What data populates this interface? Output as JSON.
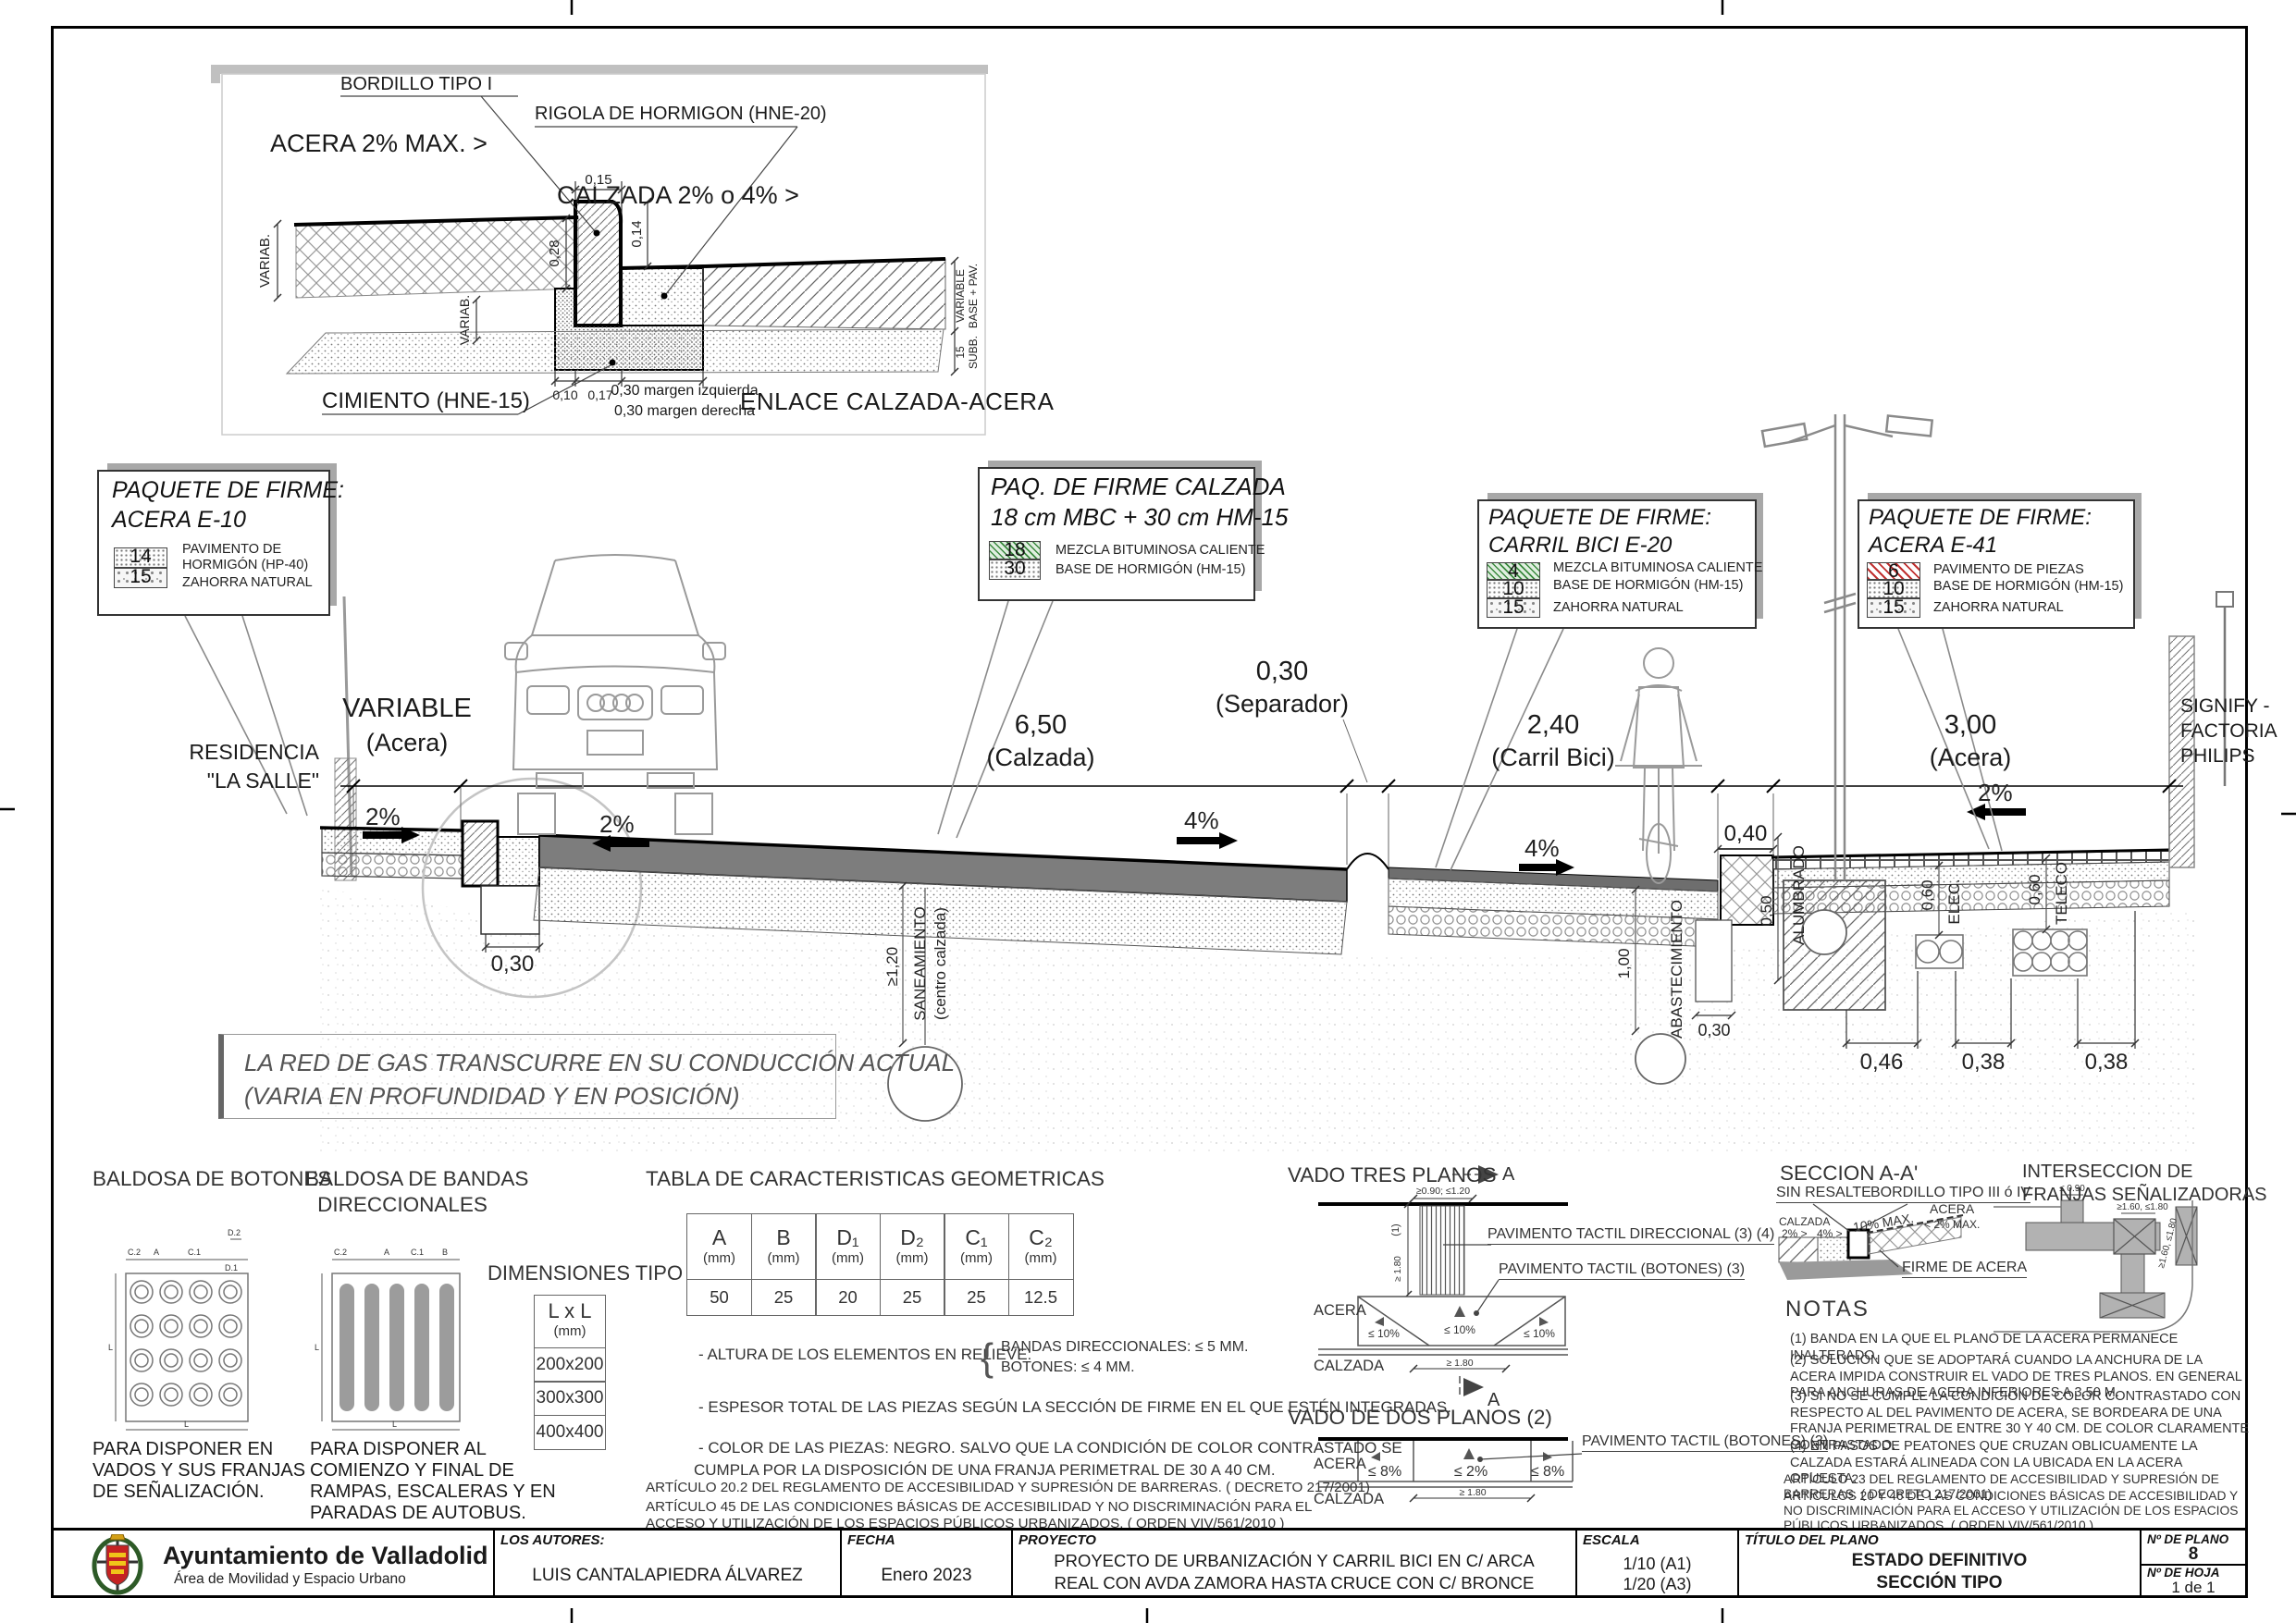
{
  "detail": {
    "title": "ENLACE CALZADA-ACERA",
    "label_bordillo": "BORDILLO TIPO I",
    "label_rigola": "RIGOLA DE HORMIGON (HNE-20)",
    "label_acera": "ACERA 2% MAX. >",
    "label_calzada": "CALZADA 2% o 4% >",
    "label_cimiento": "CIMIENTO (HNE-15)",
    "dim_015": "0,15",
    "dim_014": "0,14",
    "dim_028": "0,28",
    "dim_variab_left": "VARIAB.",
    "dim_variab_mid": "VARIAB.",
    "dim_010": "0,10",
    "dim_017": "0,17",
    "margen_1": "0,30 margen izquierda",
    "margen_2": "0,30 margen derecha",
    "dim_right_variable_1": "VARIABLE",
    "dim_right_variable_2": "BASE + PAV.",
    "dim_right_sub_1": "15",
    "dim_right_sub_2": "SUBB."
  },
  "callouts": {
    "e10": {
      "title1": "PAQUETE DE FIRME:",
      "title2": "ACERA E-10",
      "layers": [
        {
          "num": "14",
          "desc": "PAVIMENTO DE HORMIGÓN (HP-40)"
        },
        {
          "num": "15",
          "desc": "ZAHORRA NATURAL"
        }
      ]
    },
    "calzada": {
      "title1": "PAQ. DE FIRME CALZADA",
      "title2": "18 cm MBC  + 30  cm HM-15",
      "layers": [
        {
          "num": "18",
          "desc": "MEZCLA BITUMINOSA CALIENTE"
        },
        {
          "num": "30",
          "desc": "BASE DE HORMIGÓN (HM-15)"
        }
      ]
    },
    "e20": {
      "title1": "PAQUETE DE FIRME:",
      "title2": "CARRIL BICI E-20",
      "layers": [
        {
          "num": "4",
          "desc": "MEZCLA BITUMINOSA CALIENTE"
        },
        {
          "num": "10",
          "desc": "BASE DE HORMIGÓN (HM-15)"
        },
        {
          "num": "15",
          "desc": "ZAHORRA NATURAL"
        }
      ]
    },
    "e41": {
      "title1": "PAQUETE DE FIRME:",
      "title2": "ACERA E-41",
      "layers": [
        {
          "num": "6",
          "desc": "PAVIMENTO DE PIEZAS"
        },
        {
          "num": "10",
          "desc": "BASE DE HORMIGÓN (HM-15)"
        },
        {
          "num": "15",
          "desc": "ZAHORRA NATURAL"
        }
      ]
    }
  },
  "section": {
    "residencia_1": "RESIDENCIA",
    "residencia_2": "\"LA SALLE\"",
    "dim_variable": "VARIABLE",
    "dim_variable_sub": "(Acera)",
    "dim_calzada": "6,50",
    "dim_calzada_sub": "(Calzada)",
    "dim_separador": "0,30",
    "dim_separador_sub": "(Separador)",
    "dim_carril": "2,40",
    "dim_carril_sub": "(Carril Bici)",
    "dim_acera_r": "3,00",
    "dim_acera_r_sub": "(Acera)",
    "dim_040": "0,40",
    "signify_1": "SIGNIFY -",
    "signify_2": "FACTORIA",
    "signify_3": "PHILIPS",
    "slope_acera_l": "2%",
    "slope_calzada_l": "2%",
    "slope_calzada_r": "4%",
    "slope_carril": "4%",
    "slope_acera_r": "2%",
    "dim_030_trench": "0,30",
    "saneamiento_1": "SANEAMIENTO",
    "saneamiento_2": "(centro calzada)",
    "dim_120": "≥1,20",
    "abastecimiento": "ABASTECIMIENTO",
    "dim_100": "1,00",
    "dim_030_abas": "0,30",
    "alumbrado": "ALUMBRADO",
    "dim_050": "0,50",
    "elec": "ELEC.",
    "dim_060_elec": "0,60",
    "teleco": "TELECO",
    "dim_060_teleco": "0,60",
    "dim_046": "0,46",
    "dim_038_a": "0,38",
    "dim_038_b": "0,38",
    "gas_1": "LA RED DE GAS TRANSCURRE EN SU CONDUCCIÓN ACTUAL",
    "gas_2": "(VARIA EN PROFUNDIDAD Y EN POSICIÓN)"
  },
  "legend": {
    "botones": {
      "title": "BALDOSA DE BOTONES",
      "dims": {
        "c2": "C.2",
        "a": "A",
        "c1": "C.1",
        "d1": "D.1",
        "d2": "D.2",
        "l": "L"
      },
      "caption_1": "PARA DISPONER EN",
      "caption_2": "VADOS Y  SUS FRANJAS",
      "caption_3": "DE SEÑALIZACIÓN."
    },
    "bandas": {
      "title_1": "BALDOSA DE BANDAS",
      "title_2": "DIRECCIONALES",
      "dims": {
        "c2": "C.2",
        "a": "A",
        "c1": "C.1",
        "b": "B",
        "l": "L"
      },
      "caption_1": "PARA DISPONER AL",
      "caption_2": "COMIENZO Y  FINAL DE",
      "caption_3": "RAMPAS, ESCALERAS Y EN",
      "caption_4": "PARADAS DE AUTOBUS."
    },
    "dimensiones": {
      "title": "DIMENSIONES TIPO",
      "header_1": "L x L",
      "header_2": "(mm)",
      "rows": [
        "200x200",
        "300x300",
        "400x400"
      ]
    },
    "tabla": {
      "title": "TABLA DE CARACTERISTICAS GEOMETRICAS",
      "headers": [
        {
          "sym": "A",
          "unit": "(mm)"
        },
        {
          "sym": "B",
          "unit": "(mm)"
        },
        {
          "sym": "D₁",
          "unit": "(mm)"
        },
        {
          "sym": "D₂",
          "unit": "(mm)"
        },
        {
          "sym": "C₁",
          "unit": "(mm)"
        },
        {
          "sym": "C₂",
          "unit": "(mm)"
        }
      ],
      "values": [
        "50",
        "25",
        "20",
        "25",
        "25",
        "12.5"
      ],
      "nota_altura": "- ALTURA DE LOS ELEMENTOS EN RELIEVE:",
      "brace": "{",
      "nota_altura_b1": "BANDAS DIRECCIONALES: ≤ 5 MM.",
      "nota_altura_b2": "BOTONES: ≤ 4 MM.",
      "nota_espesor": "- ESPESOR TOTAL DE LAS PIEZAS SEGÚN LA SECCIÓN DE FIRME EN EL QUE ESTÉN INTEGRADAS.",
      "nota_color_1": "- COLOR DE LAS PIEZAS: NEGRO. SALVO QUE LA CONDICIÓN DE COLOR CONTRASTADO SE",
      "nota_color_2": "CUMPLA POR LA DISPOSICIÓN DE UNA FRANJA   PERIMETRAL DE 30 A 40 CM.",
      "articulo_1": "ARTÍCULO 20.2 DEL REGLAMENTO DE ACCESIBILIDAD Y SUPRESIÓN DE BARRERAS. ( DECRETO 217/2001)",
      "articulo_2": "ARTÍCULO 45 DE LAS CONDICIONES BÁSICAS DE ACCESIBILIDAD Y NO DISCRIMINACIÓN PARA EL",
      "articulo_3": "ACCESO Y UTILIZACIÓN DE LOS ESPACIOS PÚBLICOS URBANIZADOS. ( ORDEN VIV/561/2010 )"
    },
    "vado3": {
      "title": "VADO TRES PLANOS",
      "marker": "A",
      "marker_b": "A",
      "dim_top": "≥0.90; ≤1.20",
      "dim_v": "≥ 1.80",
      "ref1": "(1)",
      "label_dir": "PAVIMENTO TACTIL DIRECCIONAL (3) (4)",
      "label_bot": "PAVIMENTO TACTIL (BOTONES) (3)",
      "acera": "ACERA",
      "calzada": "CALZADA",
      "slope_l": "≤ 10%",
      "slope_c": "≤ 10%",
      "slope_r": "≤ 10%",
      "dim_bottom": "≥ 1.80"
    },
    "vado2": {
      "title": "VADO DE DOS PLANOS (2)",
      "acera": "ACERA",
      "calzada": "CALZADA",
      "slope_l": "≤ 8%",
      "slope_c": "≤ 2%",
      "slope_r": "≤ 8%",
      "label_bot": "PAVIMENTO TACTIL (BOTONES) (3)",
      "dim_bottom": "≥ 1.80"
    },
    "seccion_aa": {
      "title": "SECCION A-A'",
      "sin_resalte": "SIN RESALTE",
      "bordillo": "BORDILLO TIPO III ó IV",
      "calzada": "CALZADA",
      "p2": "2% >",
      "p4": "4% >",
      "p10": "10% MAX.",
      "acera": "ACERA",
      "p2max": "< 2% MAX.",
      "firme": "FIRME DE ACERA"
    },
    "interseccion": {
      "title_1": "INTERSECCION DE",
      "title_2": "FRANJAS SEÑALIZADORAS",
      "dim_1": "≤ 0.90",
      "dim_2": "≥1.60, ≤1.80",
      "dim_3": "≥1.60, ≤1.80"
    },
    "notas": {
      "title": "NOTAS",
      "n1": "(1)   BANDA EN LA QUE EL PLANO DE LA ACERA PERMANECE INALTERADO.",
      "n2": "(2)   SOLUCIÓN QUE SE ADOPTARÁ CUANDO LA ANCHURA DE LA ACERA IMPIDA CONSTRUIR EL VADO DE TRES PLANOS. EN GENERAL PARA ANCHURAS DE ACERA INFERIORES A 3.50 M.",
      "n3": "(3)   SI NO SE CUMPLE LA CONDICIÓN DE COLOR CONTRASTADO CON RESPECTO AL DEL PAVIMENTO DE ACERA, SE BORDEARA DE UNA FRANJA PERIMETRAL DE ENTRE 30 Y 40 CM. DE COLOR CLARAMENTE CONTRASTADO.",
      "n4": "(4)   EN PASOS DE PEATONES QUE CRUZAN OBLICUAMENTE LA CALZADA ESTARÁ ALINEADA CON  LA UBICADA EN LA ACERA OPUESTA.",
      "a1": "ARTÍCULO 23 DEL REGLAMENTO DE ACCESIBILIDAD Y SUPRESIÓN DE BARRERAS. ( DECRETO 217/2001)",
      "a2": "ARTÍCULOS 20 Y 46 DE LAS CONDICIONES BÁSICAS DE ACCESIBILIDAD Y NO DISCRIMINACIÓN PARA EL ACCESO Y UTILIZACIÓN DE LOS ESPACIOS PÚBLICOS URBANIZADOS. ( ORDEN VIV/561/2010 )"
    }
  },
  "titleblock": {
    "org": "Ayuntamiento de Valladolid",
    "org_sub": "Área de Movilidad y Espacio Urbano",
    "autores_label": "LOS AUTORES:",
    "autores": "LUIS CANTALAPIEDRA ÁLVAREZ",
    "fecha_label": "FECHA",
    "fecha": "Enero 2023",
    "proyecto_label": "PROYECTO",
    "proyecto_1": "PROYECTO DE URBANIZACIÓN Y CARRIL BICI EN C/ ARCA",
    "proyecto_2": "REAL CON AVDA ZAMORA HASTA CRUCE CON C/ BRONCE",
    "escala_label": "ESCALA",
    "escala_1": "1/10 (A1)",
    "escala_2": "1/20 (A3)",
    "titulo_label": "TÍTULO DEL PLANO",
    "titulo_1": "ESTADO DEFINITIVO",
    "titulo_2": "SECCIÓN TIPO",
    "nplano_label": "Nº DE PLANO",
    "nplano": "8",
    "nhoja_label": "Nº DE HOJA",
    "nhoja": "1 de 1"
  }
}
